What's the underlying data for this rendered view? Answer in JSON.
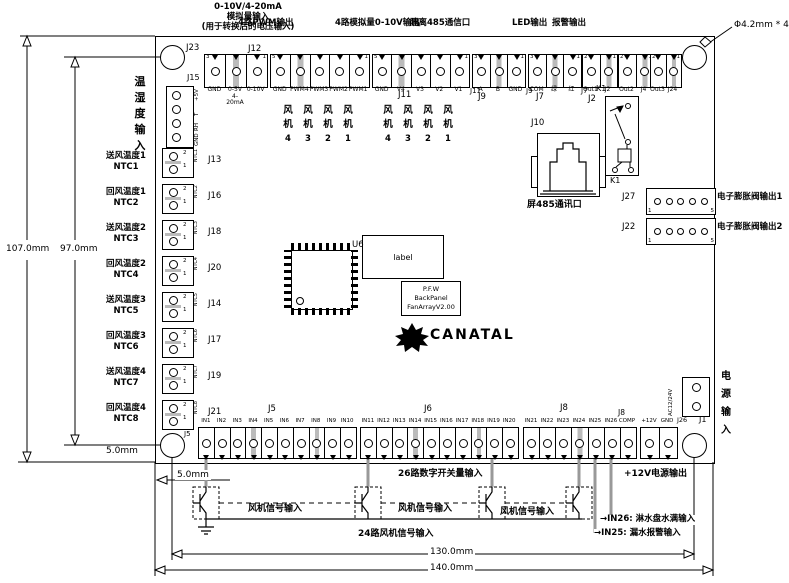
{
  "annotations": {
    "analog_in": "0-10V/4-20mA\n模拟量输入\n(用于转换后的电压输入)",
    "pwm_out": "4路PWM输出",
    "analog_out": "4路模拟量0-10V输出",
    "rs485_port": "隔离485通信口",
    "led_out": "LED输出",
    "alarm_out": "报警输出",
    "hole_spec": "Φ4.2mm * 4",
    "temp_hum_in": "温\n湿\n度\n输\n入",
    "power_in": "电\n源\n输\n入",
    "eev_out1": "电子膨胀阀输出1",
    "eev_out2": "电子膨胀阀输出2",
    "screen_485_port": "屏485通讯口",
    "digital_in_26": "26路数字开关量输入",
    "fan_signal_in_1": "风机信号输入",
    "fan_signal_in_2": "风机信号输入",
    "fan_signal_in_3": "风机信号输入",
    "fan_signal_24": "24路风机信号输入",
    "p12v_out": "+12V电源输出",
    "in26_note": "→IN26: 淋水盘水满输入",
    "in25_note": "→IN25: 漏水报警输入"
  },
  "dimensions": {
    "d107": "107.0mm",
    "d97": "97.0mm",
    "d5_left": "5.0mm",
    "d5_bottom": "5.0mm",
    "d130": "130.0mm",
    "d140": "140.0mm"
  },
  "designators": {
    "j23": "J23",
    "j12": "J12",
    "j15": "J15",
    "j11": "J11",
    "j9": "J9",
    "j7": "J7",
    "j2": "J2",
    "k1_top": "K1",
    "k1_bottom": "K1",
    "j10": "J10",
    "j27": "J27",
    "j22": "J22",
    "j1": "J1",
    "j5": "J5",
    "j5_side": "J5",
    "j6": "J6",
    "j8": "J8",
    "j8_side": "J8",
    "j26": "J26",
    "u6": "U6"
  },
  "top_connectors": {
    "j23": {
      "pn_l": "3",
      "pn_r": "1",
      "cells": [
        "GND",
        "0-5V\n4-20mA",
        "0-10V"
      ]
    },
    "j12": {
      "pn_l": "5",
      "pn_r": "1",
      "cells": [
        "GND",
        "PWM4",
        "PWM3",
        "PWM2",
        "PWM1"
      ]
    },
    "j11": {
      "pn_l": "5",
      "pn_r": "1",
      "cells": [
        "GND",
        "V4",
        "V3",
        "V2",
        "V1"
      ],
      "inline_des": "J11"
    },
    "j9": {
      "pn_l": "3",
      "pn_r": "1",
      "cells": [
        "A",
        "B",
        "GND"
      ],
      "inline_des": "J9"
    },
    "j7": {
      "pn_l": "3",
      "pn_r": "1",
      "cells": [
        "COM",
        "绿",
        "红"
      ],
      "inline_des": "J7"
    },
    "j2": {
      "pn_l": "2",
      "pn_r": "1",
      "cells": [
        "Out1",
        "J2"
      ]
    },
    "j4": {
      "pn_l": "2",
      "pn_r": "1",
      "cells": [
        "Out2",
        "J4"
      ]
    },
    "j24": {
      "pn_l": "2",
      "pn_r": "1",
      "cells": [
        "Out3",
        "J24"
      ]
    }
  },
  "left_connectors": {
    "j15_pins": [
      "+5V",
      "T",
      "RH",
      "GND"
    ],
    "ntc_pin_top": "2",
    "ntc_pin_bottom": "1",
    "rows": [
      {
        "label": "送风温度1\nNTC1",
        "des": "J13",
        "ntc": "NTC1"
      },
      {
        "label": "回风温度1\nNTC2",
        "des": "J16",
        "ntc": "NTC2"
      },
      {
        "label": "送风温度2\nNTC3",
        "des": "J18",
        "ntc": "NTC3"
      },
      {
        "label": "回风温度2\nNTC4",
        "des": "J20",
        "ntc": "NTC4"
      },
      {
        "label": "送风温度3\nNTC5",
        "des": "J14",
        "ntc": "NTC5"
      },
      {
        "label": "回风温度3\nNTC6",
        "des": "J17",
        "ntc": "NTC6"
      },
      {
        "label": "送风温度4\nNTC7",
        "des": "J19",
        "ntc": "NTC7"
      },
      {
        "label": "回风温度4\nNTC8",
        "des": "J21",
        "ntc": "NTC8"
      }
    ]
  },
  "fan_groups": {
    "char_top": "风",
    "char_bottom": "机",
    "numbers": [
      "4",
      "3",
      "2",
      "1"
    ]
  },
  "bottom_connectors": {
    "j5": {
      "cells": [
        "IN1",
        "IN2",
        "IN3",
        "IN4",
        "IN5",
        "IN6",
        "IN7",
        "IN8",
        "IN9",
        "IN10"
      ]
    },
    "j6": {
      "cells": [
        "IN11",
        "IN12",
        "IN13",
        "IN14",
        "IN15",
        "IN16",
        "IN17",
        "IN18",
        "IN19",
        "IN20"
      ]
    },
    "j8": {
      "cells": [
        "IN21",
        "IN22",
        "IN23",
        "IN24",
        "IN25",
        "IN26",
        "COMP"
      ]
    },
    "j26": {
      "cells": [
        "+12V",
        "GND"
      ]
    }
  },
  "right_side": {
    "j27_pin_l": "1",
    "j27_pin_r": "5",
    "j22_pin_l": "1",
    "j22_pin_r": "5",
    "ac_label": "AC12/24V"
  },
  "center": {
    "label_box": "label",
    "version": "P.F.W\nBackPanel\nFanArrayV2.00",
    "brand": "CANATAL"
  }
}
